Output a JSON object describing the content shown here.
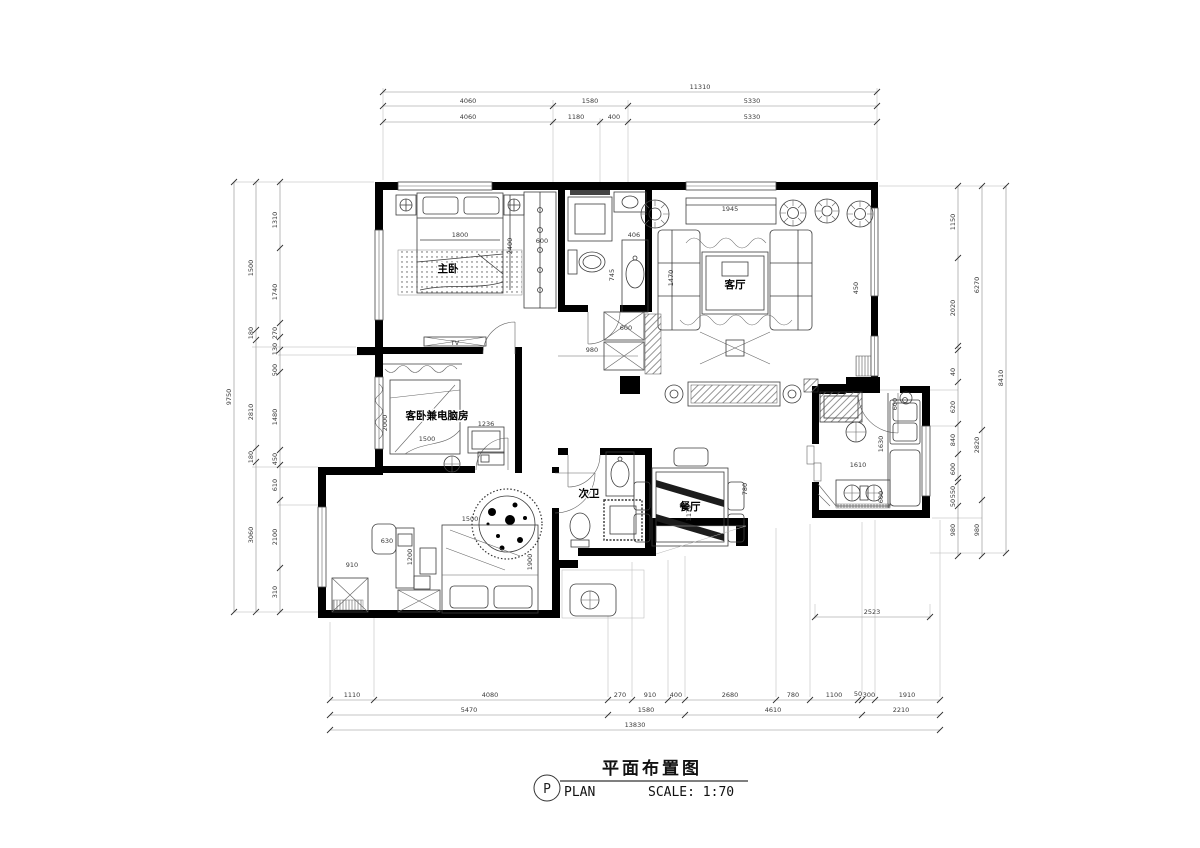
{
  "title_block": {
    "mark": "P",
    "title_cn": "平面布置图",
    "label_en": "PLAN",
    "scale_label": "SCALE: 1:70"
  },
  "annotations": [
    {
      "t": "主卧",
      "x": 448,
      "y": 272,
      "cls": "room"
    },
    {
      "t": "客厅",
      "x": 735,
      "y": 288,
      "cls": "room"
    },
    {
      "t": "客卧兼电脑房",
      "x": 437,
      "y": 419,
      "cls": "room"
    },
    {
      "t": "次卫",
      "x": 589,
      "y": 497,
      "cls": "room"
    },
    {
      "t": "餐厅",
      "x": 690,
      "y": 510,
      "cls": "room"
    },
    {
      "t": "11310",
      "x": 700,
      "y": 89
    },
    {
      "t": "4060",
      "x": 468,
      "y": 103
    },
    {
      "t": "1580",
      "x": 590,
      "y": 103
    },
    {
      "t": "5330",
      "x": 752,
      "y": 103
    },
    {
      "t": "4060",
      "x": 468,
      "y": 119
    },
    {
      "t": "1180",
      "x": 576,
      "y": 119
    },
    {
      "t": "400",
      "x": 614,
      "y": 119
    },
    {
      "t": "5330",
      "x": 752,
      "y": 119
    },
    {
      "t": "1110",
      "x": 352,
      "y": 697
    },
    {
      "t": "4080",
      "x": 490,
      "y": 697
    },
    {
      "t": "270",
      "x": 620,
      "y": 697
    },
    {
      "t": "910",
      "x": 650,
      "y": 697
    },
    {
      "t": "400",
      "x": 676,
      "y": 697
    },
    {
      "t": "2680",
      "x": 730,
      "y": 697
    },
    {
      "t": "780",
      "x": 793,
      "y": 697
    },
    {
      "t": "1100",
      "x": 834,
      "y": 697
    },
    {
      "t": "50",
      "x": 858,
      "y": 696
    },
    {
      "t": "300",
      "x": 869,
      "y": 697
    },
    {
      "t": "1910",
      "x": 907,
      "y": 697
    },
    {
      "t": "5470",
      "x": 469,
      "y": 712
    },
    {
      "t": "1580",
      "x": 646,
      "y": 712
    },
    {
      "t": "4610",
      "x": 773,
      "y": 712
    },
    {
      "t": "2210",
      "x": 901,
      "y": 712
    },
    {
      "t": "13830",
      "x": 635,
      "y": 727
    },
    {
      "t": "1310",
      "x": 277,
      "y": 220,
      "r": -90
    },
    {
      "t": "1740",
      "x": 277,
      "y": 292,
      "r": -90
    },
    {
      "t": "270",
      "x": 277,
      "y": 333,
      "r": -90
    },
    {
      "t": "130",
      "x": 277,
      "y": 349,
      "r": -90
    },
    {
      "t": "500",
      "x": 277,
      "y": 370,
      "r": -90
    },
    {
      "t": "1480",
      "x": 277,
      "y": 417,
      "r": -90
    },
    {
      "t": "450",
      "x": 277,
      "y": 459,
      "r": -90
    },
    {
      "t": "610",
      "x": 277,
      "y": 485,
      "r": -90
    },
    {
      "t": "2100",
      "x": 277,
      "y": 537,
      "r": -90
    },
    {
      "t": "310",
      "x": 277,
      "y": 592,
      "r": -90
    },
    {
      "t": "1500",
      "x": 253,
      "y": 268,
      "r": -90
    },
    {
      "t": "180",
      "x": 253,
      "y": 333,
      "r": -90
    },
    {
      "t": "2810",
      "x": 253,
      "y": 412,
      "r": -90
    },
    {
      "t": "180",
      "x": 253,
      "y": 457,
      "r": -90
    },
    {
      "t": "3060",
      "x": 253,
      "y": 535,
      "r": -90
    },
    {
      "t": "9750",
      "x": 231,
      "y": 397,
      "r": -90
    },
    {
      "t": "1150",
      "x": 955,
      "y": 222,
      "r": -90
    },
    {
      "t": "2020",
      "x": 955,
      "y": 308,
      "r": -90
    },
    {
      "t": "40",
      "x": 955,
      "y": 372,
      "r": -90
    },
    {
      "t": "620",
      "x": 955,
      "y": 407,
      "r": -90
    },
    {
      "t": "840",
      "x": 955,
      "y": 440,
      "r": -90
    },
    {
      "t": "600",
      "x": 955,
      "y": 469,
      "r": -90
    },
    {
      "t": "550",
      "x": 955,
      "y": 492,
      "r": -90
    },
    {
      "t": "50",
      "x": 955,
      "y": 503,
      "r": -90
    },
    {
      "t": "980",
      "x": 955,
      "y": 530,
      "r": -90
    },
    {
      "t": "6270",
      "x": 979,
      "y": 285,
      "r": -90
    },
    {
      "t": "2820",
      "x": 979,
      "y": 445,
      "r": -90
    },
    {
      "t": "980",
      "x": 979,
      "y": 530,
      "r": -90
    },
    {
      "t": "8410",
      "x": 1003,
      "y": 378,
      "r": -90
    },
    {
      "t": "2523",
      "x": 872,
      "y": 614
    },
    {
      "t": "1800",
      "x": 460,
      "y": 237
    },
    {
      "t": "2400",
      "x": 512,
      "y": 246,
      "r": -90
    },
    {
      "t": "600",
      "x": 542,
      "y": 243
    },
    {
      "t": "406",
      "x": 634,
      "y": 237
    },
    {
      "t": "745",
      "x": 614,
      "y": 275,
      "r": -90
    },
    {
      "t": "1945",
      "x": 730,
      "y": 211
    },
    {
      "t": "1470",
      "x": 673,
      "y": 278,
      "r": -90
    },
    {
      "t": "450",
      "x": 858,
      "y": 288,
      "r": -90
    },
    {
      "t": "980",
      "x": 592,
      "y": 352
    },
    {
      "t": "600",
      "x": 626,
      "y": 330
    },
    {
      "t": "TV",
      "x": 455,
      "y": 345
    },
    {
      "t": "1236",
      "x": 486,
      "y": 426
    },
    {
      "t": "1500",
      "x": 427,
      "y": 441
    },
    {
      "t": "2000",
      "x": 387,
      "y": 423,
      "r": -90
    },
    {
      "t": "630",
      "x": 387,
      "y": 543
    },
    {
      "t": "1200",
      "x": 412,
      "y": 557,
      "r": -90
    },
    {
      "t": "910",
      "x": 352,
      "y": 567
    },
    {
      "t": "1500",
      "x": 470,
      "y": 521
    },
    {
      "t": "1900",
      "x": 532,
      "y": 562,
      "r": -90
    },
    {
      "t": "780",
      "x": 747,
      "y": 489,
      "r": -90
    },
    {
      "t": "1170",
      "x": 691,
      "y": 513,
      "r": -90
    },
    {
      "t": "1610",
      "x": 858,
      "y": 467
    },
    {
      "t": "1630",
      "x": 883,
      "y": 444,
      "r": -90
    },
    {
      "t": "600",
      "x": 897,
      "y": 404,
      "r": -90
    },
    {
      "t": "600",
      "x": 883,
      "y": 497,
      "r": -90
    }
  ]
}
